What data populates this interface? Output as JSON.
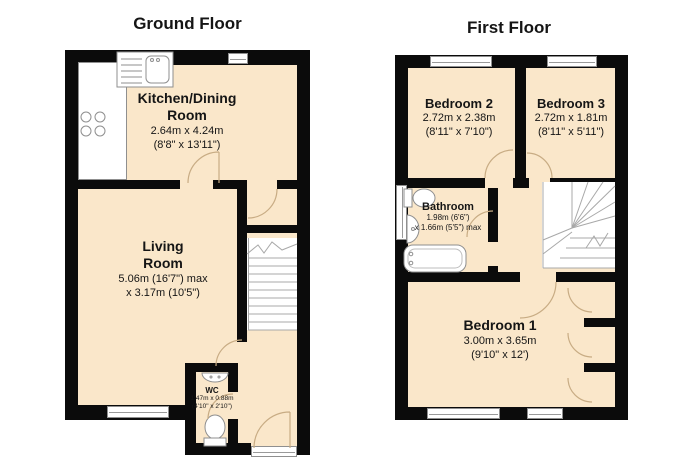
{
  "colors": {
    "wall": "#0b0b0b",
    "room_fill": "#FAE7CA",
    "fixture_stroke": "#8f8f8f",
    "door_arc": "#c8ac84",
    "background": "#ffffff"
  },
  "ground_floor": {
    "title": "Ground Floor",
    "kitchen": {
      "name1": "Kitchen/Dining",
      "name2": "Room",
      "metric": "2.64m x 4.24m",
      "imperial": "(8'8\" x 13'11\")"
    },
    "living": {
      "name1": "Living",
      "name2": "Room",
      "metric": "5.06m (16'7\") max",
      "imperial": "x 3.17m (10'5\")"
    },
    "wc": {
      "name": "WC",
      "metric": "1.47m x 0.88m",
      "imperial": "(4'10\" x 2'10\")"
    }
  },
  "first_floor": {
    "title": "First Floor",
    "bedroom2": {
      "name": "Bedroom 2",
      "metric": "2.72m x 2.38m",
      "imperial": "(8'11\" x 7'10\")"
    },
    "bedroom3": {
      "name": "Bedroom 3",
      "metric": "2.72m x 1.81m",
      "imperial": "(8'11\" x 5'11\")"
    },
    "bathroom": {
      "name": "Bathroom",
      "metric": "1.98m (6'6\")",
      "imperial": "x 1.66m (5'5\") max"
    },
    "bedroom1": {
      "name": "Bedroom 1",
      "metric": "3.00m x 3.65m",
      "imperial": "(9'10\" x 12')"
    }
  }
}
